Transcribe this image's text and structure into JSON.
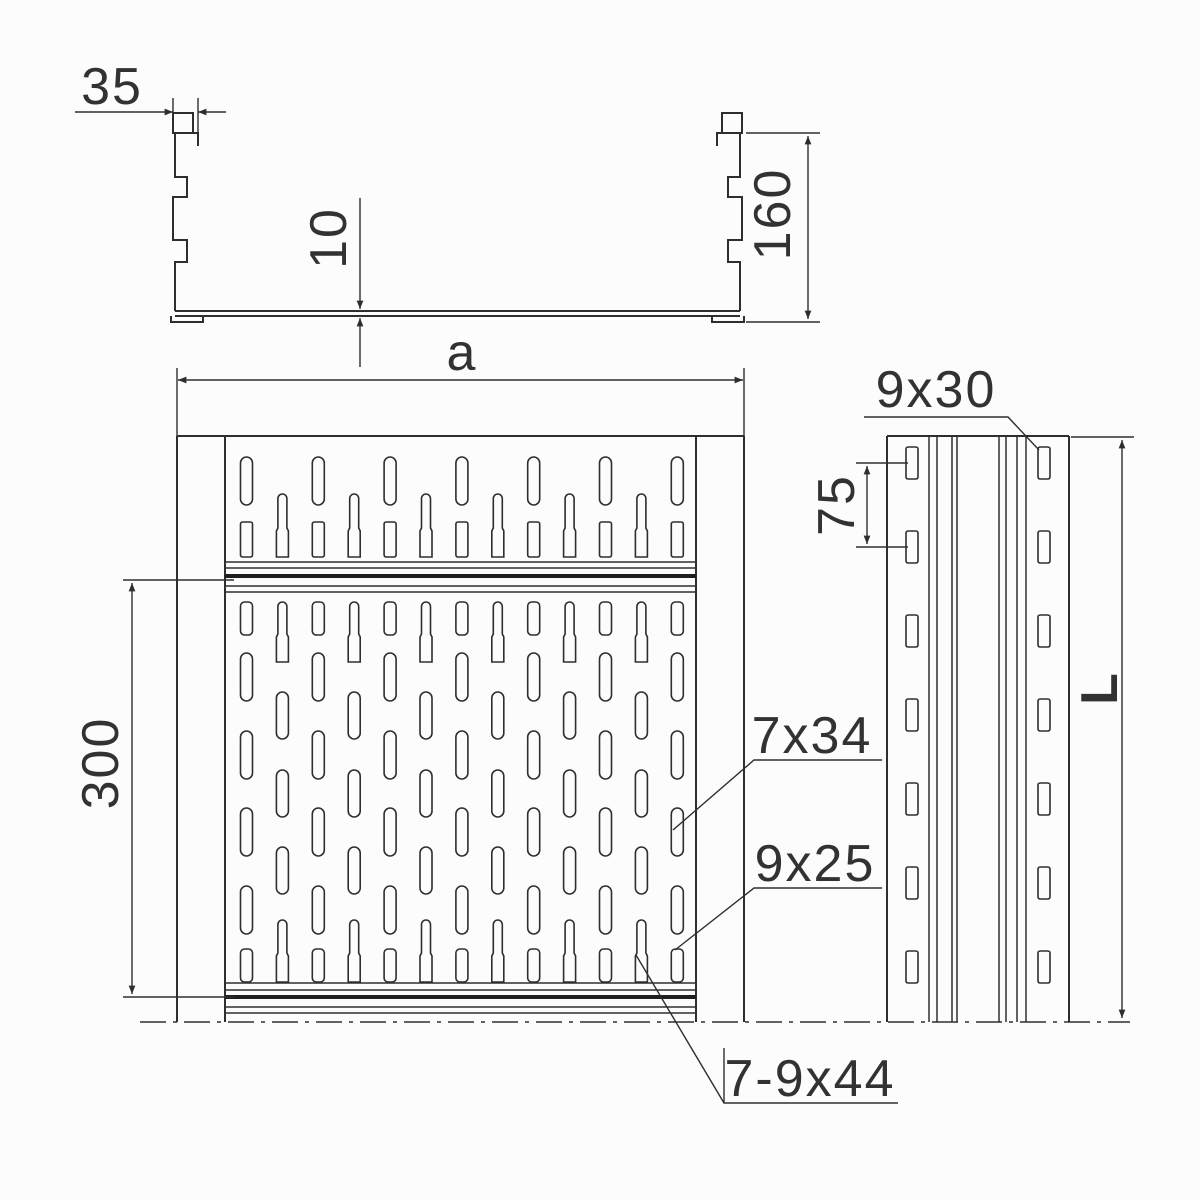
{
  "title": "perforated-cable-tray-technical-drawing",
  "colors": {
    "background": "#fcfcfc",
    "line": "#2e2e2e",
    "text": "#323232"
  },
  "cross_section": {
    "rim_width": "35",
    "bottom_thickness": "10",
    "height": "160"
  },
  "plan_view": {
    "width_label": "a",
    "joint_spacing": "300",
    "slot_label_34": "7x34",
    "slot_label_25": "9x25",
    "slot_label_44": "7-9x44"
  },
  "side_view": {
    "slot_label_30": "9x30",
    "slot_spacing": "75",
    "length_label": "L"
  }
}
